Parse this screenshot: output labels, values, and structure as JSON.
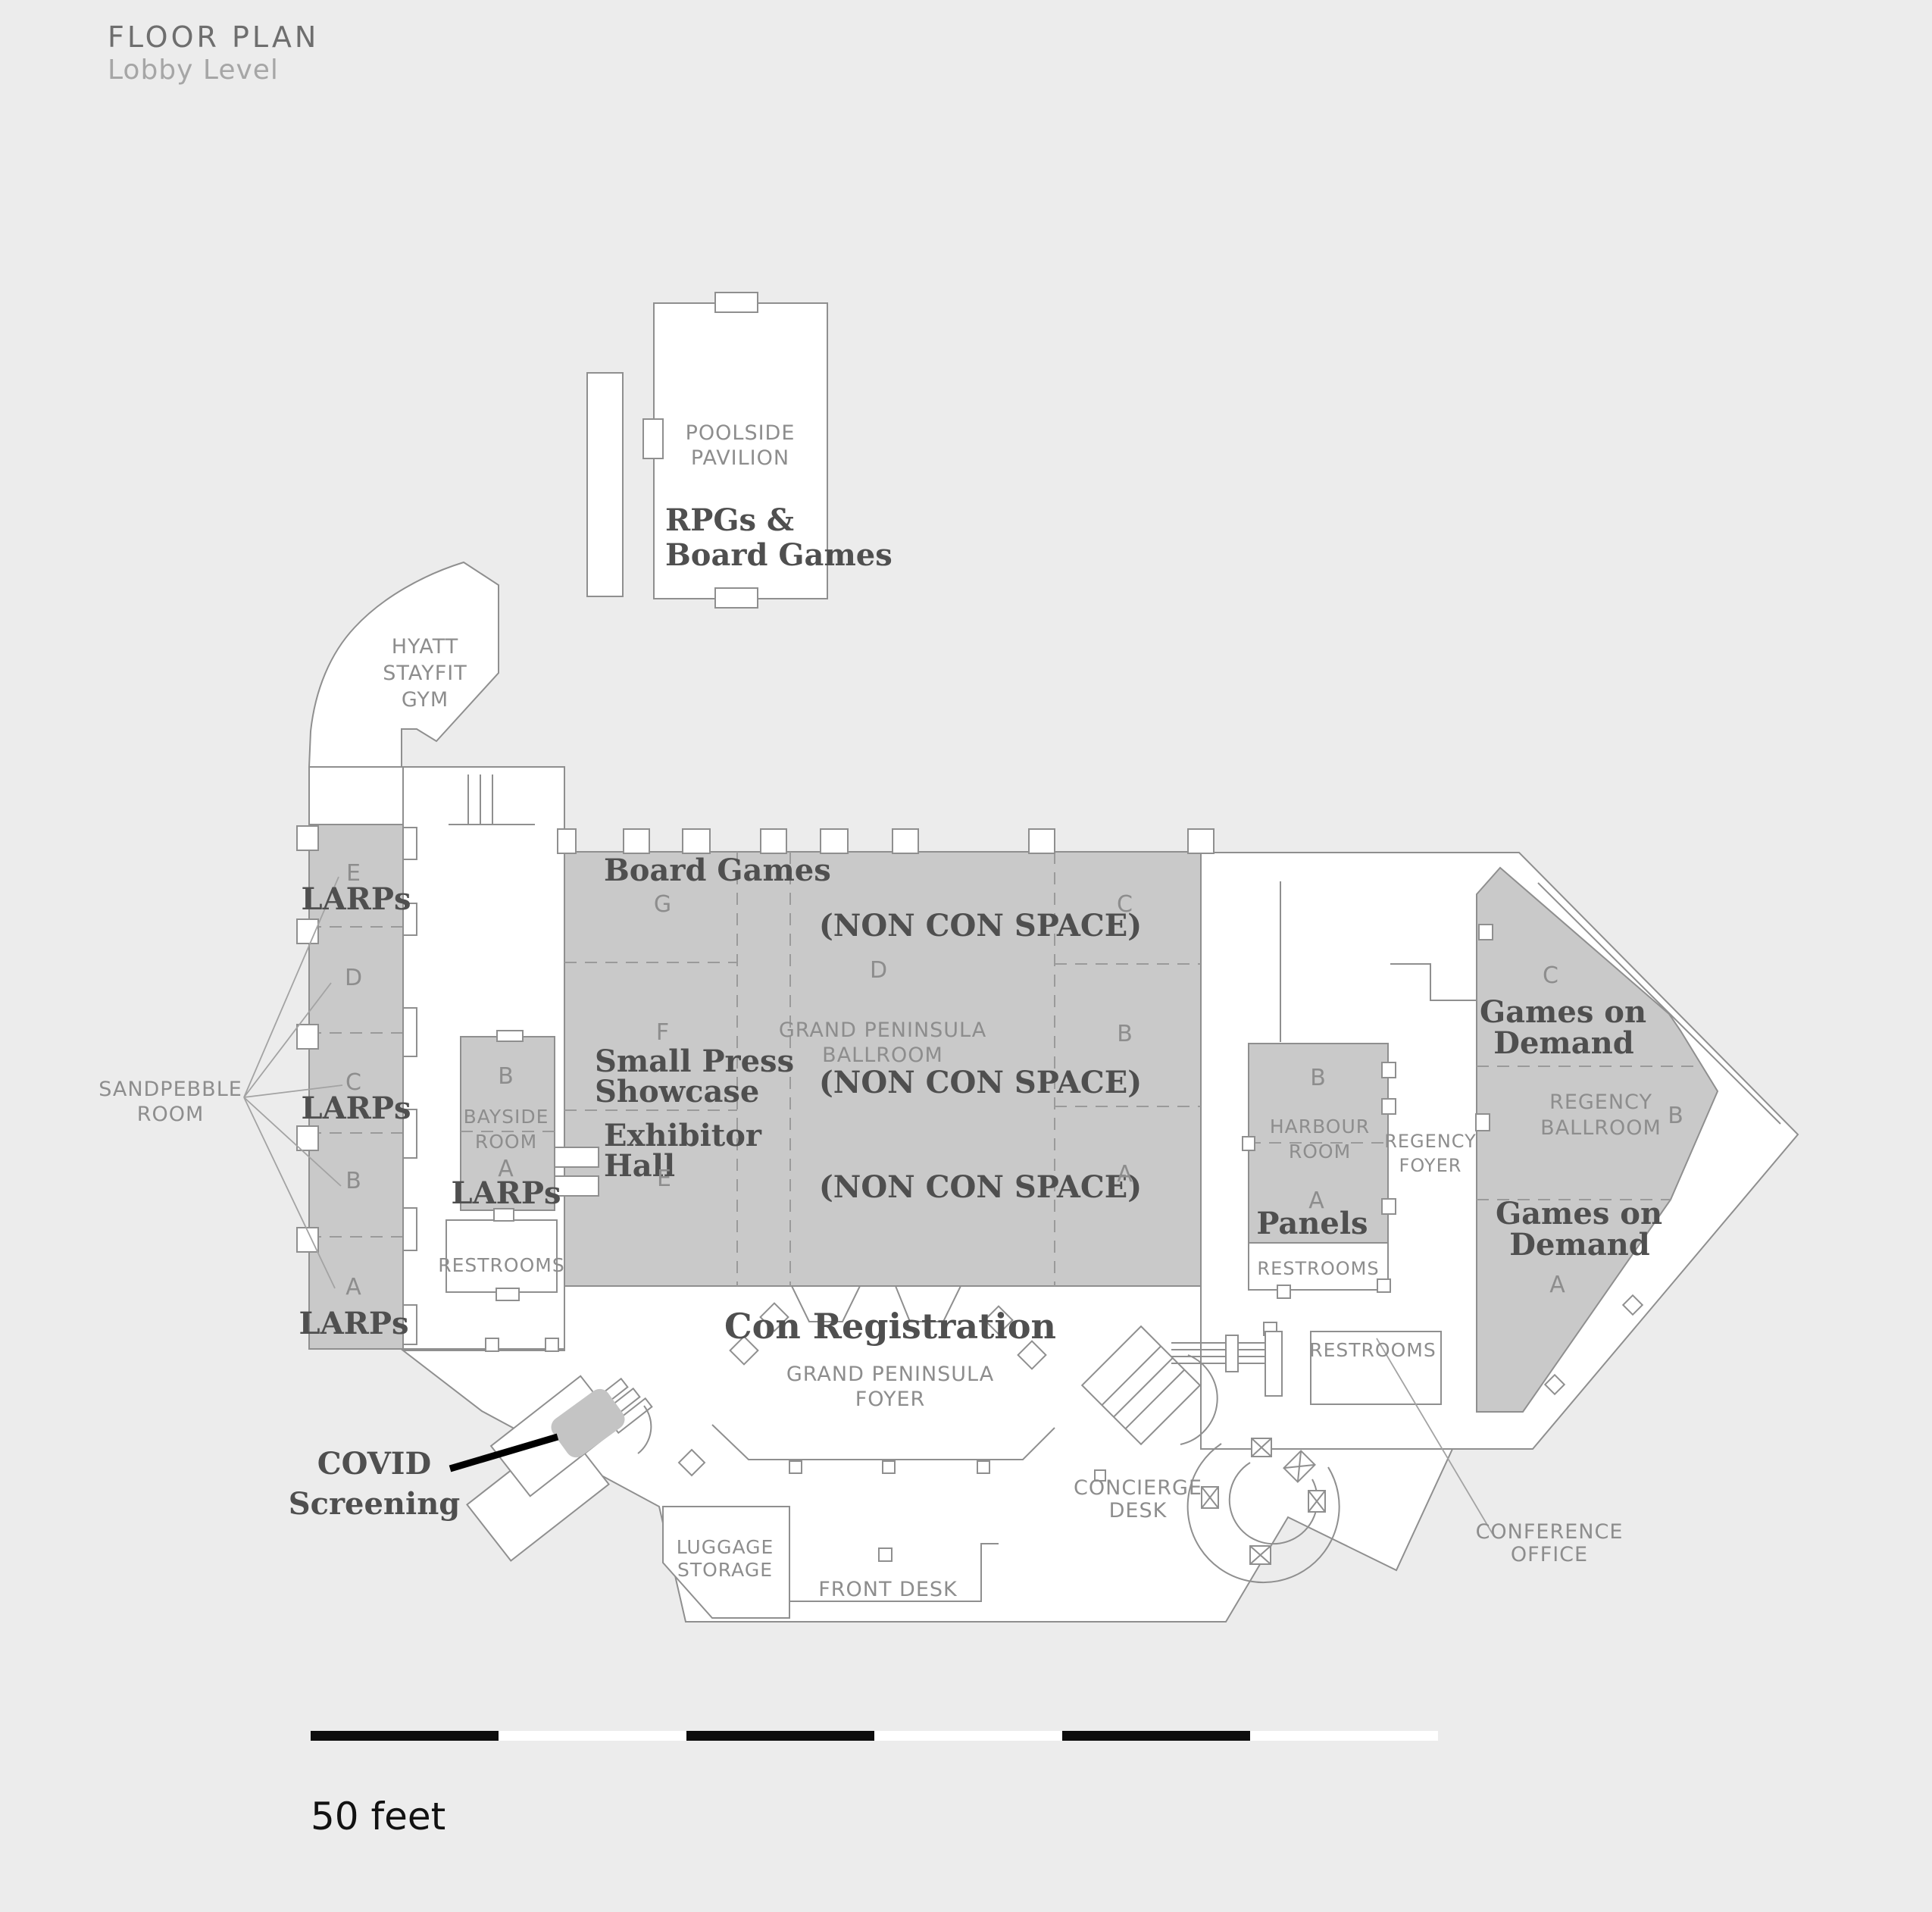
{
  "header": {
    "title": "FLOOR PLAN",
    "subtitle": "Lobby Level"
  },
  "common": {
    "restrooms": "RESTROOMS",
    "larps": "LARPs"
  },
  "poolside": {
    "name1": "POOLSIDE",
    "name2": "PAVILION",
    "act1": "RPGs &",
    "act2": "Board Games"
  },
  "gym": {
    "l1": "HYATT",
    "l2": "STAYFIT",
    "l3": "GYM"
  },
  "sandpebble": {
    "name1": "SANDPEBBLE",
    "name2": "ROOM",
    "sections": [
      "E",
      "D",
      "C",
      "B",
      "A"
    ]
  },
  "bayside": {
    "name1": "BAYSIDE",
    "name2": "ROOM",
    "sections": [
      "B",
      "A"
    ]
  },
  "ballroom": {
    "name1": "GRAND PENINSULA",
    "name2": "BALLROOM",
    "board_games": "Board Games",
    "small1": "Small Press",
    "small2": "Showcase",
    "exh1": "Exhibitor",
    "exh2": "Hall",
    "non_con": "(NON CON SPACE)",
    "sections": [
      "G",
      "F",
      "E",
      "D",
      "C",
      "B",
      "A"
    ]
  },
  "foyer": {
    "reg": "Con Registration",
    "name1": "GRAND PENINSULA",
    "name2": "FOYER"
  },
  "covid": {
    "l1": "COVID",
    "l2": "Screening"
  },
  "harbour": {
    "name1": "HARBOUR",
    "name2": "ROOM",
    "sections": [
      "B",
      "A"
    ],
    "panels": "Panels"
  },
  "regfoyer": {
    "l1": "REGENCY",
    "l2": "FOYER"
  },
  "regency": {
    "name1": "REGENCY",
    "name2": "BALLROOM",
    "sections": [
      "C",
      "B",
      "A"
    ],
    "games1": "Games on",
    "games2": "Demand"
  },
  "lobby": {
    "luggage1": "LUGGAGE",
    "luggage2": "STORAGE",
    "front_desk": "FRONT DESK",
    "concierge1": "CONCIERGE",
    "concierge2": "DESK",
    "conference1": "CONFERENCE",
    "conference2": "OFFICE"
  },
  "scale": {
    "label": "50 feet"
  }
}
